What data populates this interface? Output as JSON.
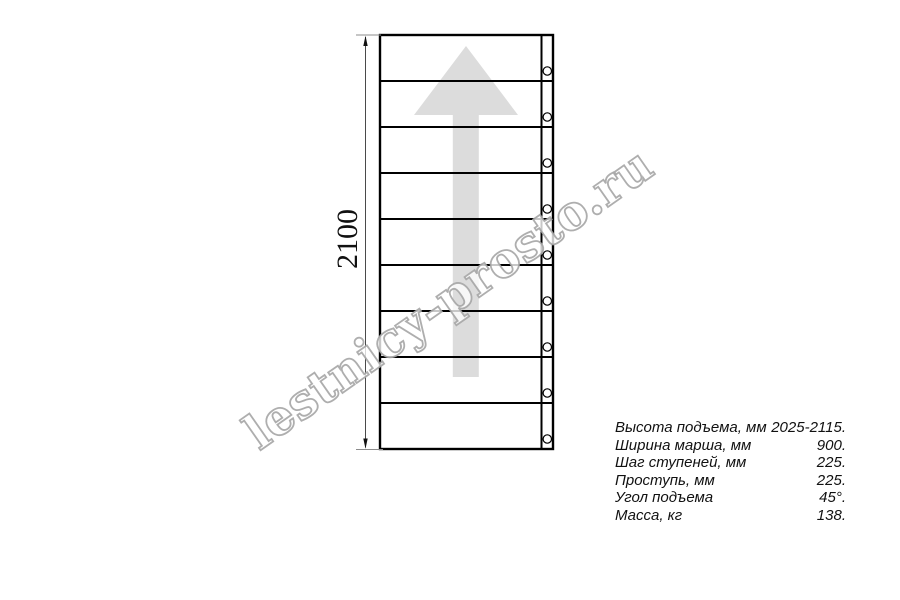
{
  "drawing": {
    "type": "staircase-plan-top-view",
    "dimension_label": "2100",
    "steps_count": 9,
    "arrow_direction": "up",
    "line_color": "#000000",
    "arrow_color": "#dcdcdc"
  },
  "watermark": {
    "text": "lestnicy-prosto.ru",
    "outline_color": "#a5a5a5"
  },
  "specs": {
    "rows": [
      {
        "label": "Высота подъема, мм",
        "value": "2025-2115."
      },
      {
        "label": "Ширина марша, мм",
        "value": "900."
      },
      {
        "label": "Шаг ступеней, мм",
        "value": "225."
      },
      {
        "label": "Проступь, мм",
        "value": "225."
      },
      {
        "label": "Угол подъема",
        "value": "45°."
      },
      {
        "label": "Масса, кг",
        "value": "138."
      }
    ]
  }
}
